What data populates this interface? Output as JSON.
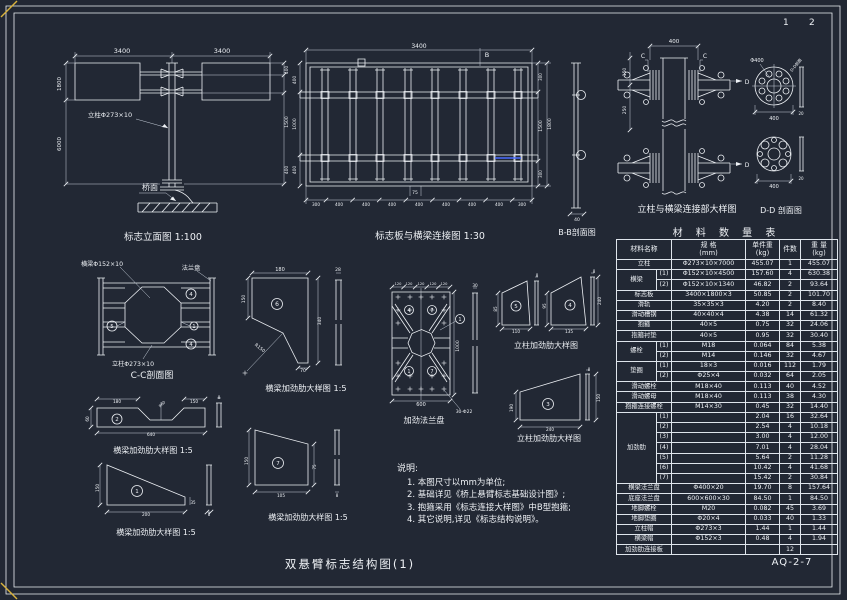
{
  "sheet": {
    "title": "双悬臂标志结构图(1)",
    "code": "AQ-2-7",
    "page_left": "1",
    "page_right": "2"
  },
  "notes": {
    "title": "说明:",
    "items": [
      "1. 本图尺寸以mm为单位;",
      "2. 基础详见《桥上悬臂标志基础设计图》;",
      "3. 抱箍采用《标志连接大样图》中B型抱箍;",
      "4. 其它说明,详见《标志结构说明》。"
    ]
  },
  "table": {
    "title": "材 料 数 量 表",
    "headers": [
      "材料名称",
      "规  格\n(mm)",
      "单件重\n(kg)",
      "件数",
      "重 量\n(kg)"
    ],
    "rows": [
      {
        "name": "立柱",
        "spec": "Φ273×10×7000",
        "unit": "455.07",
        "qty": "1",
        "wt": "455.07"
      },
      {
        "name": "横梁",
        "span": 2,
        "sub": "(1)",
        "spec": "Φ152×10×4500",
        "unit": "157.60",
        "qty": "4",
        "wt": "630.38"
      },
      {
        "sub": "(2)",
        "spec": "Φ152×10×1340",
        "unit": "46.82",
        "qty": "2",
        "wt": "93.64"
      },
      {
        "name": "标志板",
        "spec": "3400×1800×3",
        "unit": "50.85",
        "qty": "2",
        "wt": "101.70"
      },
      {
        "name": "滑轨",
        "spec": "35×35×3",
        "unit": "4.20",
        "qty": "2",
        "wt": "8.40"
      },
      {
        "name": "滑动槽钢",
        "spec": "40×40×4",
        "unit": "4.38",
        "qty": "14",
        "wt": "61.32"
      },
      {
        "name": "抱箍",
        "spec": "40×5",
        "unit": "0.75",
        "qty": "32",
        "wt": "24.06"
      },
      {
        "name": "抱箍衬垫",
        "spec": "40×5",
        "unit": "0.95",
        "qty": "32",
        "wt": "30.40"
      },
      {
        "name": "螺栓",
        "span": 2,
        "sub": "(1)",
        "spec": "M18",
        "unit": "0.064",
        "qty": "84",
        "wt": "5.38"
      },
      {
        "sub": "(2)",
        "spec": "M14",
        "unit": "0.146",
        "qty": "32",
        "wt": "4.67"
      },
      {
        "name": "垫圈",
        "span": 2,
        "sub": "(1)",
        "spec": "18×3",
        "unit": "0.016",
        "qty": "112",
        "wt": "1.79"
      },
      {
        "sub": "(2)",
        "spec": "Φ25×4",
        "unit": "0.032",
        "qty": "64",
        "wt": "2.05"
      },
      {
        "name": "滑动螺栓",
        "spec": "M18×40",
        "unit": "0.113",
        "qty": "40",
        "wt": "4.52"
      },
      {
        "name": "滑动螺母",
        "spec": "M18×40",
        "unit": "0.113",
        "qty": "38",
        "wt": "4.30"
      },
      {
        "name": "抱箍连接螺栓",
        "spec": "M14×30",
        "unit": "0.45",
        "qty": "32",
        "wt": "14.40"
      },
      {
        "name": "加劲肋",
        "span": 7,
        "sub": "(1)",
        "spec": "",
        "unit": "2.04",
        "qty": "16",
        "wt": "32.64"
      },
      {
        "sub": "(2)",
        "spec": "",
        "unit": "2.54",
        "qty": "4",
        "wt": "10.18"
      },
      {
        "sub": "(3)",
        "spec": "",
        "unit": "3.00",
        "qty": "4",
        "wt": "12.00"
      },
      {
        "sub": "(4)",
        "spec": "",
        "unit": "7.01",
        "qty": "4",
        "wt": "28.04"
      },
      {
        "sub": "(5)",
        "spec": "",
        "unit": "5.64",
        "qty": "2",
        "wt": "11.28"
      },
      {
        "sub": "(6)",
        "spec": "",
        "unit": "10.42",
        "qty": "4",
        "wt": "41.68"
      },
      {
        "sub": "(7)",
        "spec": "",
        "unit": "15.42",
        "qty": "2",
        "wt": "30.84"
      },
      {
        "name": "横梁法兰盘",
        "spec": "Φ400×20",
        "unit": "19.70",
        "qty": "8",
        "wt": "157.64"
      },
      {
        "name": "底座法兰盘",
        "spec": "600×600×30",
        "unit": "84.50",
        "qty": "1",
        "wt": "84.50"
      },
      {
        "name": "地脚螺栓",
        "spec": "M20",
        "unit": "0.082",
        "qty": "45",
        "wt": "3.69"
      },
      {
        "name": "地脚垫圈",
        "spec": "Φ20×4",
        "unit": "0.033",
        "qty": "40",
        "wt": "1.33"
      },
      {
        "name": "立柱帽",
        "spec": "Φ273×3",
        "unit": "1.44",
        "qty": "1",
        "wt": "1.44"
      },
      {
        "name": "横梁帽",
        "spec": "Φ152×3",
        "unit": "0.48",
        "qty": "4",
        "wt": "1.94"
      },
      {
        "name": "加劲肋连接板",
        "spec": "",
        "unit": "",
        "qty": "12",
        "wt": ""
      }
    ]
  },
  "views": {
    "elevation": {
      "title": "标志立面图 1:100",
      "title_pos": [
        163,
        240
      ],
      "title_size": 9.5,
      "labels": [
        {
          "x": 122,
          "y": 53,
          "t": "3400",
          "s": 6.5
        },
        {
          "x": 222,
          "y": 53,
          "t": "3400",
          "s": 6.5
        },
        {
          "x": 61,
          "y": 84,
          "t": "1800",
          "s": 5.5,
          "r": -90
        },
        {
          "x": 61,
          "y": 144,
          "t": "6000",
          "s": 5.5,
          "r": -90
        },
        {
          "x": 288,
          "y": 70,
          "t": "400",
          "s": 4.5,
          "r": -90
        },
        {
          "x": 288,
          "y": 122,
          "t": "1500",
          "s": 4.5,
          "r": -90
        },
        {
          "x": 288,
          "y": 170,
          "t": "400",
          "s": 4.5,
          "r": -90
        },
        {
          "x": 110,
          "y": 117,
          "t": "立柱Φ273×10",
          "s": 6.5
        },
        {
          "x": 150,
          "y": 190,
          "t": "桥面",
          "s": 8
        }
      ]
    },
    "board_connection": {
      "title": "标志板与横梁连接图  1:30",
      "title_pos": [
        430,
        239
      ],
      "title_size": 9.5,
      "labels": [
        {
          "x": 419,
          "y": 48,
          "t": "3400",
          "s": 6
        },
        {
          "x": 487,
          "y": 57,
          "t": "B",
          "s": 6.5
        },
        {
          "x": 415,
          "y": 194,
          "t": "75",
          "s": 4.5
        },
        {
          "x": 316,
          "y": 206,
          "t": "300",
          "s": 4.2
        },
        {
          "x": 339,
          "y": 206,
          "t": "400",
          "s": 4.2
        },
        {
          "x": 366,
          "y": 206,
          "t": "400",
          "s": 4.2
        },
        {
          "x": 392,
          "y": 206,
          "t": "400",
          "s": 4.2
        },
        {
          "x": 419,
          "y": 206,
          "t": "400",
          "s": 4.2
        },
        {
          "x": 446,
          "y": 206,
          "t": "400",
          "s": 4.2
        },
        {
          "x": 472,
          "y": 206,
          "t": "400",
          "s": 4.2
        },
        {
          "x": 499,
          "y": 206,
          "t": "400",
          "s": 4.2
        },
        {
          "x": 522,
          "y": 206,
          "t": "300",
          "s": 4.2
        },
        {
          "x": 296,
          "y": 80,
          "t": "400",
          "s": 4.5,
          "r": -90
        },
        {
          "x": 296,
          "y": 124,
          "t": "1000",
          "s": 4.5,
          "r": -90
        },
        {
          "x": 296,
          "y": 170,
          "t": "400",
          "s": 4.5,
          "r": -90
        },
        {
          "x": 542,
          "y": 77,
          "t": "300",
          "s": 4,
          "r": -90
        },
        {
          "x": 542,
          "y": 126,
          "t": "1500",
          "s": 4.5,
          "r": -90
        },
        {
          "x": 551,
          "y": 124,
          "t": "1800",
          "s": 4.5,
          "r": -90
        },
        {
          "x": 542,
          "y": 174,
          "t": "300",
          "s": 4,
          "r": -90
        }
      ]
    },
    "bb_section": {
      "title": "B-B剖面图",
      "title_pos": [
        577,
        235
      ],
      "title_size": 8,
      "labels": [
        {
          "x": 577,
          "y": 221,
          "t": "40",
          "s": 4.5
        }
      ]
    },
    "col_beam": {
      "title": "立柱与横梁连接部大样图",
      "title_pos": [
        687,
        212
      ],
      "title_size": 9,
      "labels": [
        {
          "x": 674,
          "y": 43,
          "t": "400",
          "s": 5.5
        },
        {
          "x": 643,
          "y": 58,
          "t": "C",
          "s": 6
        },
        {
          "x": 705,
          "y": 58,
          "t": "C",
          "s": 6
        },
        {
          "x": 747,
          "y": 84,
          "t": "D",
          "s": 6
        },
        {
          "x": 747,
          "y": 167,
          "t": "D",
          "s": 6
        },
        {
          "x": 626,
          "y": 72,
          "t": "150",
          "s": 4.5,
          "r": -90
        },
        {
          "x": 626,
          "y": 110,
          "t": "250",
          "s": 4.5,
          "r": -90
        }
      ]
    },
    "dd_section": {
      "title": "D-D 剖面图",
      "title_pos": [
        781,
        213
      ],
      "title_size": 8,
      "labels": [
        {
          "x": 757,
          "y": 62,
          "t": "Φ400",
          "s": 5
        },
        {
          "x": 797,
          "y": 66,
          "t": "D-D剖面",
          "s": 4,
          "r": -50
        },
        {
          "x": 774,
          "y": 120,
          "t": "400",
          "s": 5
        },
        {
          "x": 801,
          "y": 115,
          "t": "20",
          "s": 4
        },
        {
          "x": 774,
          "y": 188,
          "t": "400",
          "s": 5
        },
        {
          "x": 801,
          "y": 180,
          "t": "20",
          "s": 4
        }
      ]
    },
    "cc_section": {
      "title": "C-C剖面图",
      "title_pos": [
        152,
        378
      ],
      "title_size": 9,
      "labels": [
        {
          "x": 102,
          "y": 266,
          "t": "横梁Φ152×10",
          "s": 6.2
        },
        {
          "x": 191,
          "y": 270,
          "t": "法兰盘",
          "s": 6.2
        },
        {
          "x": 133,
          "y": 366,
          "t": "立柱Φ273×10",
          "s": 6.2
        },
        {
          "x": 191,
          "y": 296,
          "t": "4",
          "s": 5.5
        },
        {
          "x": 112,
          "y": 328,
          "t": "5",
          "s": 5.5
        },
        {
          "x": 194,
          "y": 328,
          "t": "1",
          "s": 5
        },
        {
          "x": 191,
          "y": 346,
          "t": "4",
          "s": 5.5
        }
      ]
    },
    "beam_rib6": {
      "title": "横梁加劲肋大样图 1:5",
      "title_pos": [
        306,
        391
      ],
      "title_size": 8.2,
      "labels": [
        {
          "x": 280,
          "y": 271,
          "t": "180",
          "s": 5
        },
        {
          "x": 338,
          "y": 271,
          "t": "28",
          "s": 4.5
        },
        {
          "x": 245,
          "y": 299,
          "t": "150",
          "s": 4.5,
          "r": -90
        },
        {
          "x": 321,
          "y": 321,
          "t": "340",
          "s": 4.5,
          "r": -90
        },
        {
          "x": 259,
          "y": 349,
          "t": "R150",
          "s": 4.5,
          "r": 38
        },
        {
          "x": 303,
          "y": 372,
          "t": "70",
          "s": 4.5
        },
        {
          "x": 277,
          "y": 306,
          "t": "6",
          "s": 6
        }
      ]
    },
    "flange_plate": {
      "title": "加劲法兰盘",
      "title_pos": [
        424,
        423
      ],
      "title_size": 8.2,
      "labels": [
        {
          "x": 398,
          "y": 285,
          "t": "120",
          "s": 3.6
        },
        {
          "x": 409,
          "y": 285,
          "t": "120",
          "s": 3.6
        },
        {
          "x": 421,
          "y": 285,
          "t": "120",
          "s": 3.6
        },
        {
          "x": 433,
          "y": 285,
          "t": "120",
          "s": 3.6
        },
        {
          "x": 444,
          "y": 285,
          "t": "120",
          "s": 3.6
        },
        {
          "x": 459,
          "y": 346,
          "t": "1000",
          "s": 4.5,
          "r": -90
        },
        {
          "x": 421,
          "y": 406,
          "t": "600",
          "s": 5
        },
        {
          "x": 464,
          "y": 413,
          "t": "30-Φ22",
          "s": 4.5
        },
        {
          "x": 475,
          "y": 287,
          "t": "30",
          "s": 4.2
        },
        {
          "x": 409,
          "y": 312,
          "t": "4",
          "s": 5
        },
        {
          "x": 432,
          "y": 312,
          "t": "7",
          "s": 5
        },
        {
          "x": 460,
          "y": 321,
          "t": "1",
          "s": 5
        },
        {
          "x": 409,
          "y": 373,
          "t": "1",
          "s": 5
        },
        {
          "x": 432,
          "y": 373,
          "t": "7",
          "s": 5
        }
      ]
    },
    "col_ribs": {
      "title": "立柱加劲肋大样图",
      "title_pos": [
        546,
        348
      ],
      "title_size": 8,
      "labels": [
        {
          "x": 497,
          "y": 309,
          "t": "85",
          "s": 4.2,
          "r": -90
        },
        {
          "x": 516,
          "y": 333,
          "t": "110",
          "s": 4.2
        },
        {
          "x": 546,
          "y": 306,
          "t": "95",
          "s": 4.2,
          "r": -90
        },
        {
          "x": 569,
          "y": 333,
          "t": "135",
          "s": 4.2
        },
        {
          "x": 601,
          "y": 301,
          "t": "240",
          "s": 4.2,
          "r": -90
        },
        {
          "x": 537,
          "y": 277,
          "t": "8",
          "s": 4
        },
        {
          "x": 594,
          "y": 273,
          "t": "8",
          "s": 4
        },
        {
          "x": 516,
          "y": 308,
          "t": "5",
          "s": 5.5
        },
        {
          "x": 570,
          "y": 307,
          "t": "4",
          "s": 5.5
        }
      ]
    },
    "col_rib3": {
      "title": "立柱加劲肋大样图",
      "title_pos": [
        549,
        441
      ],
      "title_size": 8,
      "labels": [
        {
          "x": 513,
          "y": 408,
          "t": "190",
          "s": 4.2,
          "r": -90
        },
        {
          "x": 550,
          "y": 431,
          "t": "240",
          "s": 4.2
        },
        {
          "x": 600,
          "y": 398,
          "t": "150",
          "s": 4.2,
          "r": -90
        },
        {
          "x": 589,
          "y": 371,
          "t": "8",
          "s": 4
        },
        {
          "x": 548,
          "y": 406,
          "t": "3",
          "s": 5.5
        }
      ]
    },
    "notch_rib": {
      "title": "横梁加劲肋大样图 1:5",
      "title_pos": [
        153,
        453
      ],
      "title_size": 8,
      "labels": [
        {
          "x": 117,
          "y": 403,
          "t": "180",
          "s": 4.2
        },
        {
          "x": 194,
          "y": 403,
          "t": "150",
          "s": 4.2
        },
        {
          "x": 163,
          "y": 405,
          "t": "R60",
          "s": 3.8,
          "r": -45
        },
        {
          "x": 89,
          "y": 419,
          "t": "60",
          "s": 4.2,
          "r": -90
        },
        {
          "x": 151,
          "y": 436,
          "t": "640",
          "s": 4.2
        },
        {
          "x": 219,
          "y": 399,
          "t": "8",
          "s": 4
        },
        {
          "x": 117,
          "y": 421,
          "t": "2",
          "s": 5.5
        }
      ]
    },
    "tri_rib": {
      "title": "横梁加劲肋大样图 1:5",
      "title_pos": [
        156,
        535
      ],
      "title_size": 8,
      "labels": [
        {
          "x": 99,
          "y": 488,
          "t": "150",
          "s": 4.2,
          "r": -90
        },
        {
          "x": 146,
          "y": 516,
          "t": "200",
          "s": 4.2
        },
        {
          "x": 193,
          "y": 504,
          "t": "35",
          "s": 4
        },
        {
          "x": 209,
          "y": 516,
          "t": "8",
          "s": 4
        },
        {
          "x": 137,
          "y": 493,
          "t": "1",
          "s": 5.5
        }
      ]
    },
    "trap_rib": {
      "title": "横梁加劲肋大样图 1:5",
      "title_pos": [
        308,
        520
      ],
      "title_size": 8,
      "labels": [
        {
          "x": 248,
          "y": 461,
          "t": "150",
          "s": 4.2,
          "r": -90
        },
        {
          "x": 281,
          "y": 497,
          "t": "105",
          "s": 4.2
        },
        {
          "x": 316,
          "y": 467,
          "t": "75",
          "s": 4,
          "r": -90
        },
        {
          "x": 337,
          "y": 497,
          "t": "8",
          "s": 4
        },
        {
          "x": 278,
          "y": 465,
          "t": "7",
          "s": 5.5
        }
      ]
    }
  }
}
